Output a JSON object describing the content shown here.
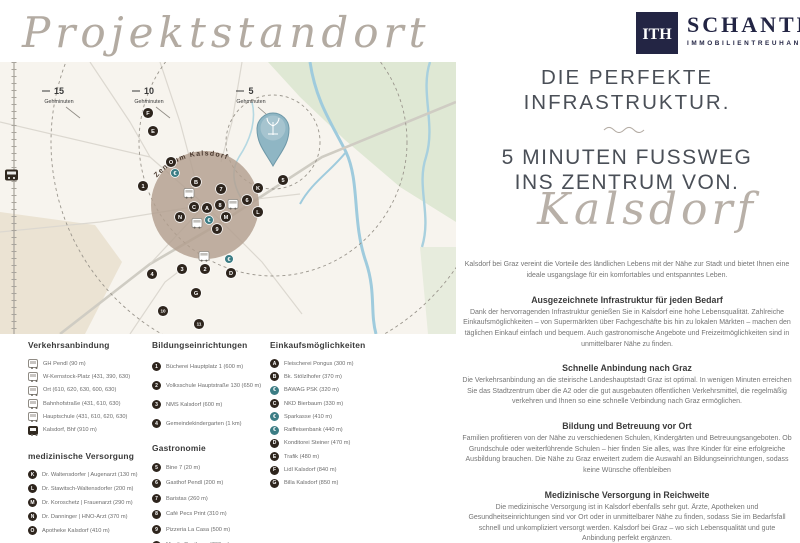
{
  "page": {
    "script_title": "Projektstandort"
  },
  "logo": {
    "mark": "ITH",
    "name": "SCHANTL",
    "subtitle": "IMMOBILIENTREUHAND"
  },
  "map": {
    "center_label": "Zentrum Kalsdorf",
    "distance_labels": [
      {
        "value": "15",
        "unit": "Gehminuten"
      },
      {
        "value": "10",
        "unit": "Gehminuten"
      },
      {
        "value": "5",
        "unit": "Gehminuten"
      }
    ],
    "markers": [
      {
        "label": "F",
        "x": 148,
        "y": 51,
        "kind": "dark"
      },
      {
        "label": "E",
        "x": 153,
        "y": 69,
        "kind": "dark"
      },
      {
        "label": "O",
        "x": 171,
        "y": 100,
        "kind": "dark"
      },
      {
        "label": "€",
        "x": 175,
        "y": 111,
        "kind": "euro"
      },
      {
        "label": "1",
        "x": 143,
        "y": 124,
        "kind": "dark"
      },
      {
        "label": "B",
        "x": 196,
        "y": 120,
        "kind": "dark"
      },
      {
        "label": "7",
        "x": 221,
        "y": 127,
        "kind": "dark"
      },
      {
        "label": "K",
        "x": 258,
        "y": 126,
        "kind": "dark"
      },
      {
        "label": "5",
        "x": 283,
        "y": 118,
        "kind": "dark"
      },
      {
        "label": "6",
        "x": 247,
        "y": 138,
        "kind": "dark"
      },
      {
        "label": "C",
        "x": 194,
        "y": 145,
        "kind": "dark"
      },
      {
        "label": "A",
        "x": 207,
        "y": 146,
        "kind": "dark"
      },
      {
        "label": "8",
        "x": 220,
        "y": 143,
        "kind": "dark"
      },
      {
        "label": "L",
        "x": 258,
        "y": 150,
        "kind": "dark"
      },
      {
        "label": "N",
        "x": 180,
        "y": 155,
        "kind": "dark"
      },
      {
        "label": "M",
        "x": 226,
        "y": 155,
        "kind": "dark"
      },
      {
        "label": "€",
        "x": 209,
        "y": 158,
        "kind": "euro"
      },
      {
        "label": "9",
        "x": 217,
        "y": 167,
        "kind": "dark"
      },
      {
        "label": "€",
        "x": 229,
        "y": 197,
        "kind": "euro"
      },
      {
        "label": "3",
        "x": 182,
        "y": 207,
        "kind": "dark"
      },
      {
        "label": "2",
        "x": 205,
        "y": 207,
        "kind": "dark"
      },
      {
        "label": "D",
        "x": 231,
        "y": 211,
        "kind": "dark"
      },
      {
        "label": "4",
        "x": 152,
        "y": 212,
        "kind": "dark"
      },
      {
        "label": "G",
        "x": 196,
        "y": 231,
        "kind": "dark"
      },
      {
        "label": "10",
        "x": 163,
        "y": 249,
        "kind": "dark"
      },
      {
        "label": "11",
        "x": 199,
        "y": 262,
        "kind": "dark"
      }
    ]
  },
  "headline": {
    "h1_line1": "DIE PERFEKTE",
    "h1_line2": "INFRASTRUKTUR.",
    "h2_line1": "5 MINUTEN FUSSWEG",
    "h2_line2": "INS ZENTRUM VON.",
    "script_word": "Kalsdorf"
  },
  "intro": "Kalsdorf bei Graz vereint die Vorteile des ländlichen Lebens mit der Nähe zur Stadt und bietet Ihnen eine ideale usgangslage für ein komfortables und entspanntes Leben.",
  "sections": [
    {
      "title": "Ausgezeichnete Infrastruktur für jeden Bedarf",
      "body": "Dank der hervorragenden Infrastruktur genießen Sie in Kalsdorf eine hohe Lebensqualität. Zahlreiche Einkaufsmöglichkeiten – von Supermärkten über Fachgeschäfte bis hin zu lokalen Märkten – machen den täglichen Einkauf einfach und bequem. Auch gastronomische Angebote und Freizeitmöglichkeiten sind in unmittelbarer Nähe zu finden."
    },
    {
      "title": "Schnelle Anbindung nach Graz",
      "body": "Die Verkehrsanbindung an die steirische Landeshauptstadt Graz ist optimal. In wenigen Minuten erreichen Sie das Stadtzentrum über die A2 oder die gut ausgebauten öffentlichen Verkehrsmittel, die regelmäßig verkehren und Ihnen so eine schnelle Verbindung nach Graz ermöglichen."
    },
    {
      "title": "Bildung und Betreuung vor Ort",
      "body": "Familien profitieren von der Nähe zu verschiedenen Schulen, Kindergärten und Betreuungsangeboten. Ob Grundschule oder weiterführende Schulen – hier finden Sie alles, was Ihre Kinder für eine erfolgreiche Ausbildung brauchen. Die Nähe zu Graz erweitert zudem die Auswahl an Bildungseinrichtungen, sodass keine Wünsche offenbleiben"
    },
    {
      "title": "Medizinische Versorgung in Reichweite",
      "body": "Die medizinische Versorgung ist in Kalsdorf ebenfalls sehr gut. Ärzte, Apotheken und Gesundheitseinrichtungen sind vor Ort oder in unmittelbarer Nähe zu finden, sodass Sie im Bedarfsfall schnell und unkompliziert versorgt werden. Kalsdorf bei Graz – wo sich Lebensqualität und gute Anbindung perfekt ergänzen."
    }
  ],
  "legend": {
    "verkehr": {
      "title": "Verkehrsanbindung",
      "items": [
        {
          "icon": "bus",
          "label": "GH Pendl (90 m)"
        },
        {
          "icon": "bus",
          "label": "W-Kernstock-Platz (431, 390, 630)"
        },
        {
          "icon": "bus",
          "label": "Ort (610, 620, 630, 600, 630)"
        },
        {
          "icon": "bus",
          "label": "Bahnhofstraße (431, 610, 630)"
        },
        {
          "icon": "bus",
          "label": "Hauptschule (431, 610, 620, 630)"
        },
        {
          "icon": "train",
          "label": "Kalsdorf, Bhf (910 m)"
        }
      ]
    },
    "medizin": {
      "title": "medizinische Versorgung",
      "items": [
        {
          "marker": "K",
          "kind": "dark",
          "label": "Dr. Waltensdorfer | Augenarzt (130 m)"
        },
        {
          "marker": "L",
          "kind": "dark",
          "label": "Dr. Stawitsch-Waltensdorfer (200 m)"
        },
        {
          "marker": "M",
          "kind": "dark",
          "label": "Dr. Koroschetz | Frauenarzt (290 m)"
        },
        {
          "marker": "N",
          "kind": "dark",
          "label": "Dr. Danninger | HNO-Arzt (370 m)"
        },
        {
          "marker": "O",
          "kind": "dark",
          "label": "Apotheke Kalsdorf (410 m)"
        }
      ]
    },
    "bildung": {
      "title": "Bildungseinrichtungen",
      "items": [
        {
          "marker": "1",
          "kind": "dark",
          "label": "Bücherei Hauptplatz 1 (600 m)"
        },
        {
          "marker": "2",
          "kind": "dark",
          "label": "Volksschule Hauptstraße 130 (650 m)"
        },
        {
          "marker": "3",
          "kind": "dark",
          "label": "NMS Kalsdorf (600 m)"
        },
        {
          "marker": "4",
          "kind": "dark",
          "label": "Gemeindekindergarten (1 km)"
        }
      ]
    },
    "gastronomie": {
      "title": "Gastronomie",
      "items": [
        {
          "marker": "5",
          "kind": "dark",
          "label": "Bine 7 (20 m)"
        },
        {
          "marker": "6",
          "kind": "dark",
          "label": "Gasthof Pendl (200 m)"
        },
        {
          "marker": "7",
          "kind": "dark",
          "label": "Baristas (260 m)"
        },
        {
          "marker": "8",
          "kind": "dark",
          "label": "Café Pecs Print (310 m)"
        },
        {
          "marker": "9",
          "kind": "dark",
          "label": "Pizzeria La Casa (500 m)"
        },
        {
          "marker": "10",
          "kind": "dark wide",
          "label": "Moni's Gasthaus (760 m)"
        },
        {
          "marker": "11",
          "kind": "dark wide",
          "label": "Hotel-Restaurant Mayer (890 m)"
        }
      ]
    },
    "einkauf": {
      "title": "Einkaufsmöglichkeiten",
      "items": [
        {
          "marker": "A",
          "kind": "dark",
          "label": "Fleischerei Pongus (300 m)"
        },
        {
          "marker": "B",
          "kind": "dark",
          "label": "Bk. Stölzlhofer (370 m)"
        },
        {
          "marker": "€",
          "kind": "euro",
          "label": "BAWAG PSK (320 m)"
        },
        {
          "marker": "C",
          "kind": "dark",
          "label": "NKD Bierbaum (330 m)"
        },
        {
          "marker": "€",
          "kind": "euro",
          "label": "Sparkasse (410 m)"
        },
        {
          "marker": "€",
          "kind": "euro",
          "label": "Raiffeisenbank (440 m)"
        },
        {
          "marker": "D",
          "kind": "dark",
          "label": "Konditorei Steiner (470 m)"
        },
        {
          "marker": "E",
          "kind": "dark",
          "label": "Trafik (480 m)"
        },
        {
          "marker": "F",
          "kind": "dark",
          "label": "Lidl Kalsdorf (840 m)"
        },
        {
          "marker": "G",
          "kind": "dark",
          "label": "Billa Kalsdorf (850 m)"
        }
      ]
    }
  },
  "colors": {
    "brand_navy": "#232544",
    "dark_marker": "#2e251d",
    "euro_marker": "#3c7d85",
    "zentrum_circle": "#b29f8f",
    "map_green": "#dfe8d4",
    "map_water": "#9fcbdd",
    "script_gray": "#b3aba2",
    "headline_gray": "#4a4f57"
  }
}
